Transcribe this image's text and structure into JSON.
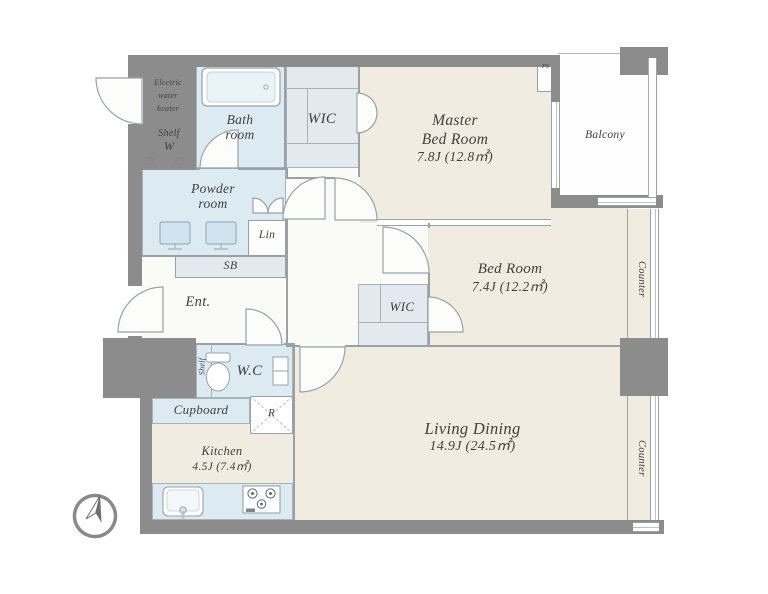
{
  "colors": {
    "wall": "#8c8c8c",
    "floor": "#f0ecdf",
    "wet_area": "#dcebf2",
    "closet": "#e3eaef",
    "outline": "#9aa1a6",
    "text": "#3f3f3f"
  },
  "icons": {
    "compass": "north-arrow"
  },
  "rooms": {
    "master_bedroom": {
      "name_line1": "Master",
      "name_line2": "Bed Room",
      "size": "7.8J (12.8㎡)"
    },
    "bedroom": {
      "name": "Bed Room",
      "size": "7.4J (12.2㎡)"
    },
    "living_dining": {
      "name": "Living Dining",
      "size": "14.9J (24.5㎡)"
    },
    "kitchen": {
      "name": "Kitchen",
      "size": "4.5J (7.4㎡)"
    },
    "bath": {
      "name_line1": "Bath",
      "name_line2": "room"
    },
    "powder_room": {
      "name_line1": "Powder",
      "name_line2": "room"
    },
    "entrance": {
      "name": "Ent."
    },
    "wc": {
      "name": "W.C",
      "shelf": "Shelf"
    },
    "wic_upper": {
      "name": "WIC"
    },
    "wic_middle": {
      "name": "WIC"
    },
    "balcony": {
      "name": "Balcony"
    },
    "shoe_box": {
      "name": "SB"
    },
    "linen": {
      "name": "Lin"
    },
    "laundry": {
      "shelf": "Shelf",
      "washer": "W"
    },
    "cupboard": {
      "name": "Cupboard"
    },
    "refrigerator": {
      "name": "R"
    },
    "electric_water_heater": {
      "line1": "Electric",
      "line2": "water",
      "line3": "heater"
    },
    "pipe_space": {
      "name": "PS"
    },
    "counter_upper": {
      "name": "Counter"
    },
    "counter_lower": {
      "name": "Counter"
    }
  }
}
